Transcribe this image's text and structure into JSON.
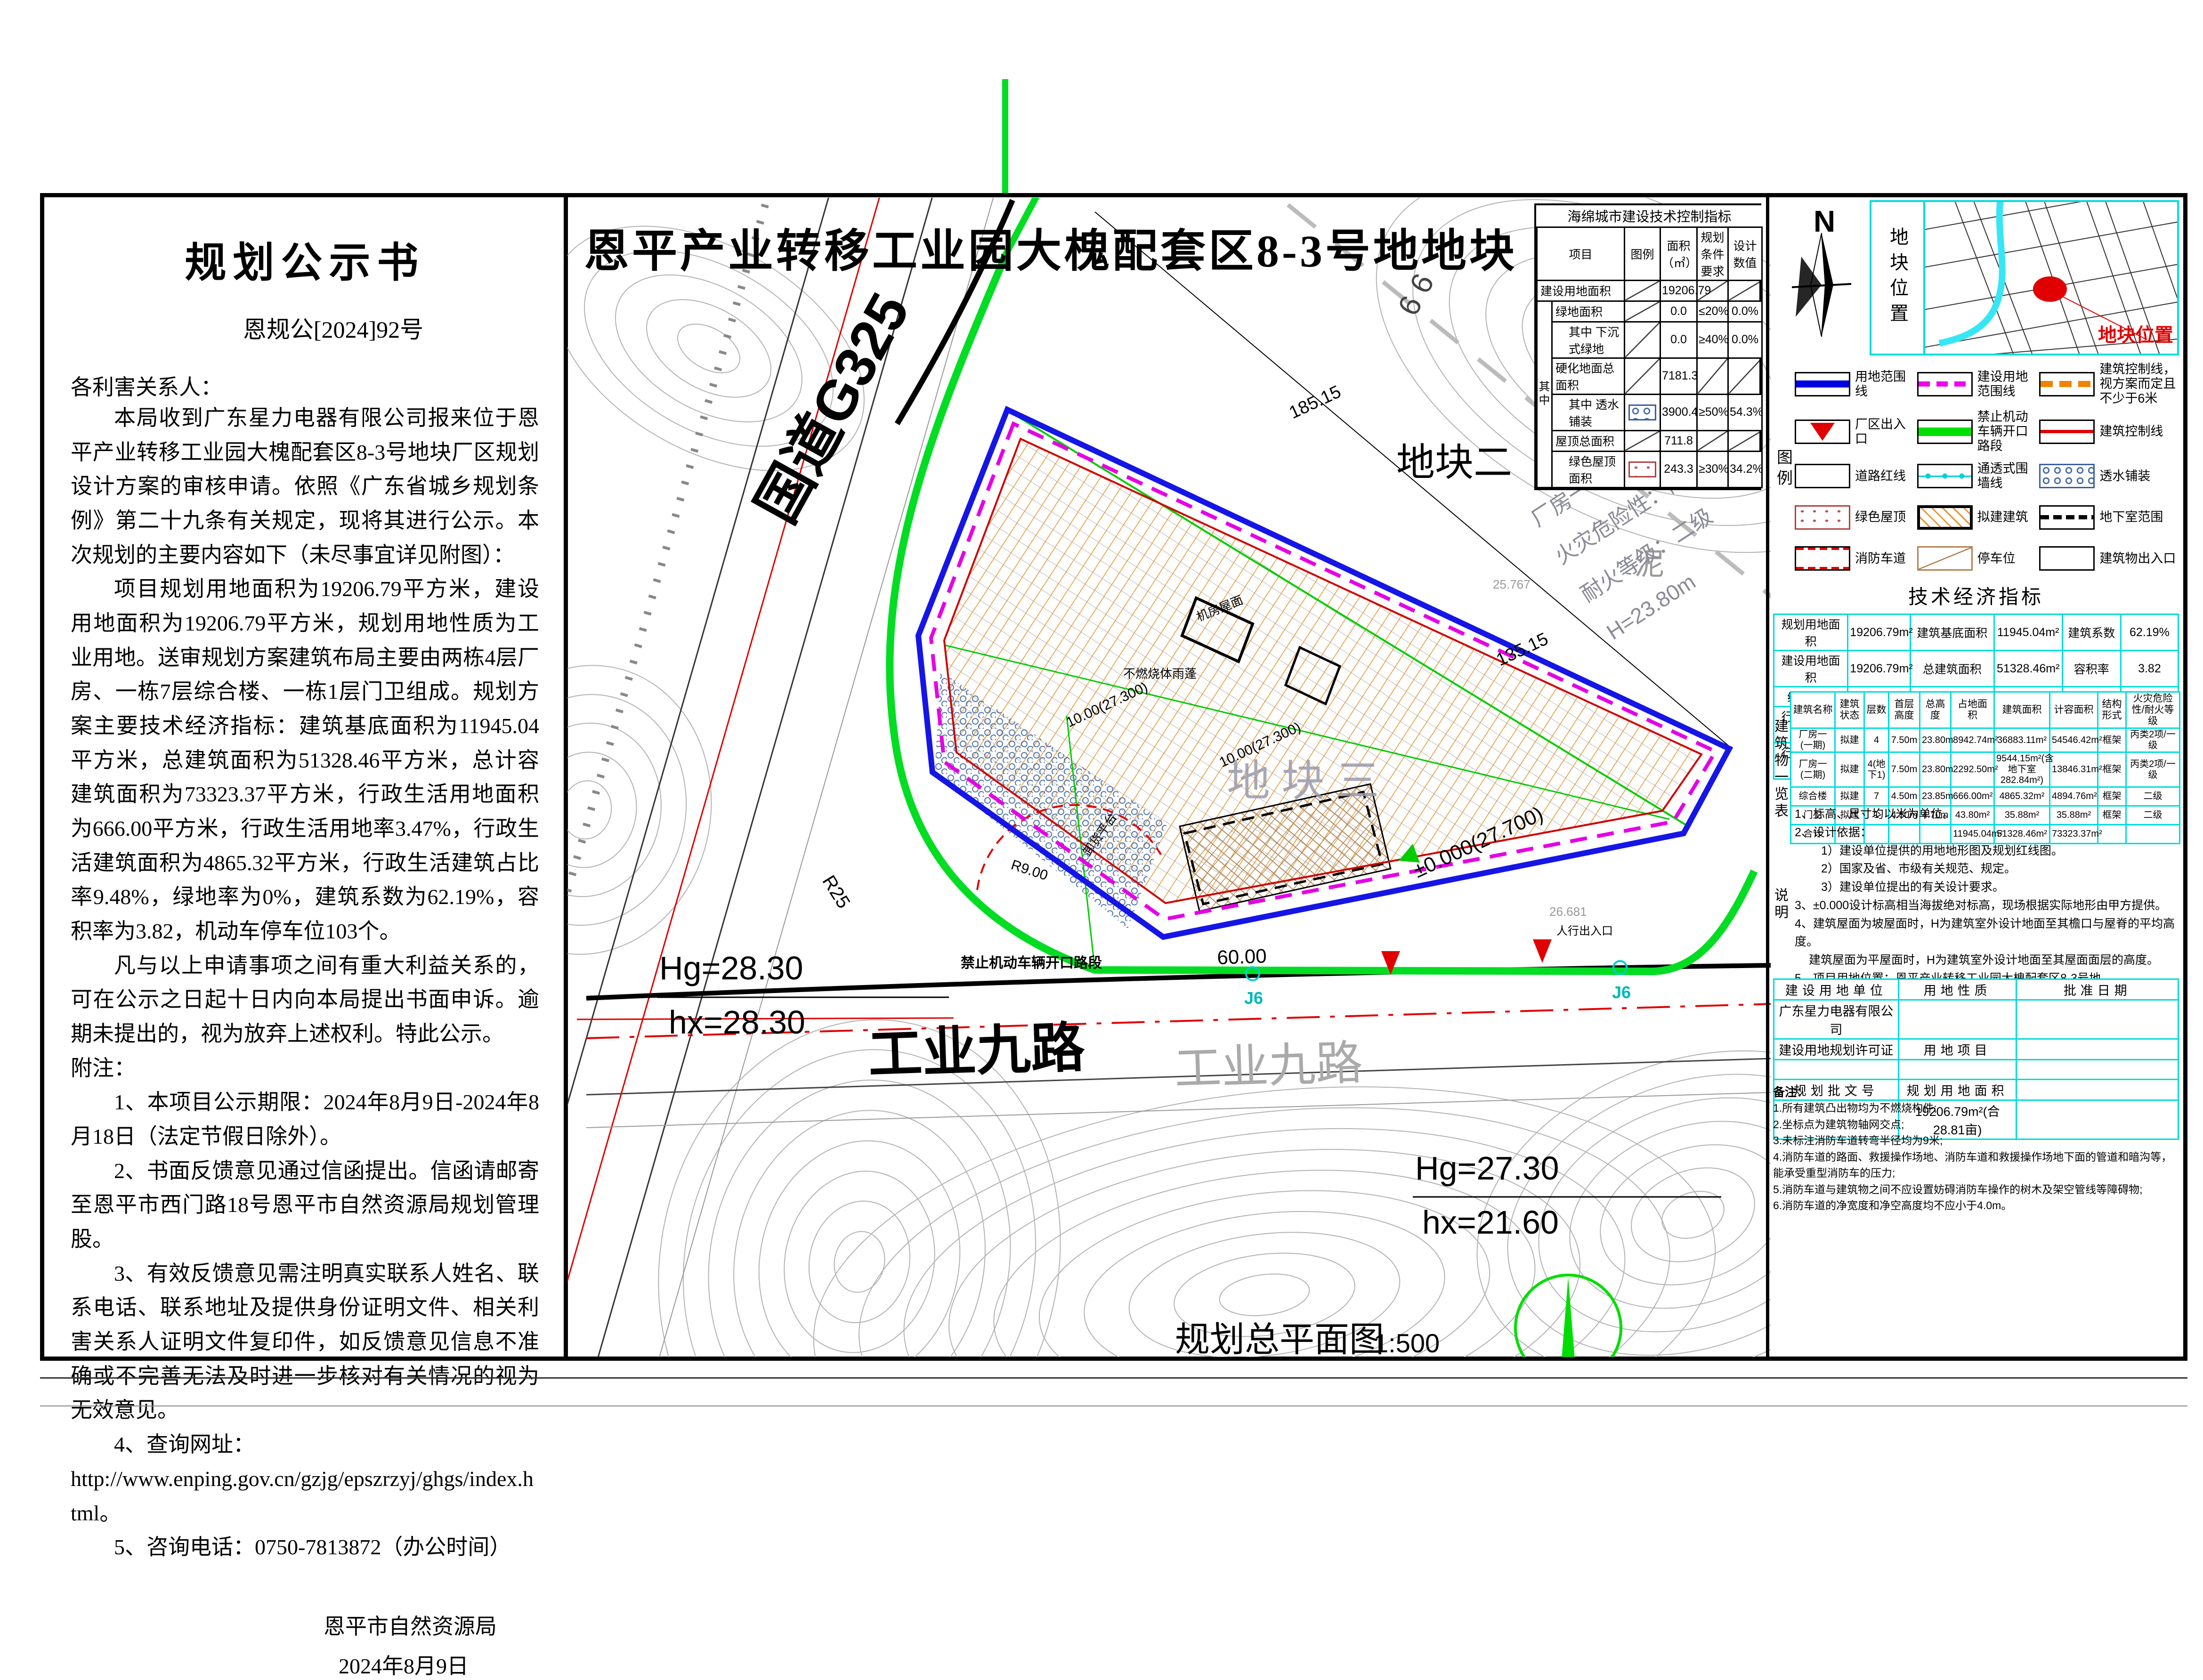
{
  "notice": {
    "title": "规划公示书",
    "doc_no": "恩规公[2024]92号",
    "salutation": "各利害关系人：",
    "paragraphs": [
      "本局收到广东星力电器有限公司报来位于恩平产业转移工业园大槐配套区8-3号地块厂区规划设计方案的审核申请。依照《广东省城乡规划条例》第二十九条有关规定，现将其进行公示。本次规划的主要内容如下（未尽事宜详见附图）：",
      "项目规划用地面积为19206.79平方米，建设用地面积为19206.79平方米，规划用地性质为工业用地。送审规划方案建筑布局主要由两栋4层厂房、一栋7层综合楼、一栋1层门卫组成。规划方案主要技术经济指标：建筑基底面积为11945.04平方米，总建筑面积为51328.46平方米，总计容建筑面积为73323.37平方米，行政生活用地面积为666.00平方米，行政生活用地率3.47%，行政生活建筑面积为4865.32平方米，行政生活建筑占比率9.48%，绿地率为0%，建筑系数为62.19%，容积率为3.82，机动车停车位103个。",
      "凡与以上申请事项之间有重大利益关系的，可在公示之日起十日内向本局提出书面申诉。逾期未提出的，视为放弃上述权利。特此公示。"
    ],
    "notes_label": "附注：",
    "notes": [
      {
        "t": "1、本项目公示期限：2024年8月9日-2024年8月18日（法定节假日除外）。",
        "c": "n-i2"
      },
      {
        "t": "2、书面反馈意见通过信函提出。信函请邮寄至恩平市西门路18号恩平市自然资源局规划管理股。",
        "c": "n-i2"
      },
      {
        "t": "3、有效反馈意见需注明真实联系人姓名、联系电话、联系地址及提供身份证明文件、相关利害关系人证明文件复印件，如反馈意见信息不准确或不完善无法及时进一步核对有关情况的视为无效意见。",
        "c": "n-i2"
      },
      {
        "t": "4、查询网址：",
        "c": "n-i2"
      },
      {
        "t": "http://www.enping.gov.cn/gzjg/epszrzyj/ghgs/index.html。",
        "c": "n-i0"
      },
      {
        "t": "5、咨询电话：0750-7813872（办公时间）",
        "c": "n-i2"
      }
    ],
    "agency": "恩平市自然资源局",
    "date": "2024年8月9日"
  },
  "map": {
    "title": "恩平产业转移工业园大槐配套区8-3号地地块",
    "caption": "规划总平面图",
    "caption_scale": "1:500",
    "road_g325": "国道G325",
    "road_gy9_a": "工业九路",
    "road_gy9_b": "工业九路",
    "elev_left_top": "Hg=28.30",
    "elev_left_bottom": "hx=28.30",
    "elev_right_top": "Hg=27.30",
    "elev_right_bottom": "hx=21.60",
    "parcel2": "地块二",
    "parcel3": "地块三",
    "mud": "泥",
    "no_open": "禁止机动车辆开口路段",
    "dim_a": "185.15",
    "dim_b": "135.15",
    "dim_c": "60.00",
    "dim_r": "R25",
    "dim_r9": "R9.00",
    "bm": "±0.000(27.700)",
    "lvl_a": "10.00(27.300)",
    "lvl_b": "10.00(27.300)",
    "spot_a": "25.767",
    "spot_b": "26.681",
    "bldg_line1": "厂房一（一期）",
    "bldg_line2": "火灾危险性：丙类",
    "bldg_line3": "耐火等级：二级",
    "bldg_line4": "H=23.80m",
    "lbl_canopy": "不燃烧体雨蓬",
    "lbl_dock": "卸货平台",
    "lbl_roof": "机房屋面",
    "lbl_ped": "人行出入口",
    "j_a": "J6",
    "j_b": "J6",
    "sixsix": "6 6"
  },
  "sponge": {
    "title": "海绵城市建设技术控制指标",
    "headers": [
      "项目",
      "图例",
      "面积（㎡）",
      "规划条件要求",
      "设计数值"
    ],
    "span_label": "其中",
    "rows": [
      {
        "label": "建设用地面积",
        "area": "19206.79",
        "req": "",
        "des": ""
      },
      {
        "label": "绿地面积",
        "area": "0.0",
        "req": "≤20%",
        "des": "0.0%"
      },
      {
        "label": "其中 下沉式绿地",
        "area": "0.0",
        "req": "≥40%",
        "des": "0.0%"
      },
      {
        "label": "硬化地面总面积",
        "area": "7181.3",
        "req": "",
        "des": ""
      },
      {
        "label": "其中 透水铺装",
        "area": "3900.4",
        "req": "≥50%",
        "des": "54.3%"
      },
      {
        "label": "屋顶总面积",
        "area": "711.8",
        "req": "",
        "des": ""
      },
      {
        "label": "绿色屋顶面积",
        "area": "243.3",
        "req": "≥30%",
        "des": "34.2%"
      }
    ]
  },
  "panel": {
    "compass_n": "N",
    "strip_label": "地块位置",
    "map_callout": "地块位置",
    "legend_side": "图例",
    "legend_items": [
      {
        "label": "用地范围线",
        "type": "sym-blueband"
      },
      {
        "label": "建设用地范围线",
        "type": "sym-magentadash"
      },
      {
        "label": "建筑控制线，视方案而定且不少于6米",
        "type": "sym-orangedash"
      },
      {
        "label": "厂区出入口",
        "type": "sym-redtri"
      },
      {
        "label": "禁止机动车辆开口路段",
        "type": "sym-greenband"
      },
      {
        "label": "建筑控制线",
        "type": "sym-redline"
      },
      {
        "label": "道路红线",
        "type": "sym-roadred"
      },
      {
        "label": "通透式围墙线",
        "type": "sym-fence"
      },
      {
        "label": "透水铺装",
        "type": "sym-hex"
      },
      {
        "label": "绿色屋顶",
        "type": "sym-plus"
      },
      {
        "label": "拟建建筑",
        "type": "sym-building"
      },
      {
        "label": "地下室范围",
        "type": "sym-basement"
      },
      {
        "label": "消防车道",
        "type": "sym-firelane"
      },
      {
        "label": "停车位",
        "type": "sym-parking"
      },
      {
        "label": "建筑物出入口",
        "type": "sym-entry"
      }
    ]
  },
  "tech": {
    "title": "技术经济指标",
    "rows": [
      [
        "规划用地面积",
        "19206.79m²",
        "建筑基底面积",
        "11945.04m²",
        "建筑系数",
        "62.19%"
      ],
      [
        "建设用地面积",
        "19206.79m²",
        "总建筑面积",
        "51328.46m²",
        "容积率",
        "3.82"
      ],
      [
        "绿地面积",
        "0.00m²",
        "计容建筑面积",
        "73323.37m²",
        "绿地率",
        "0.00%"
      ],
      [
        "行政生活用地面积",
        "666.00m²",
        "行政生活用地率",
        "3.47%",
        "停车位",
        "103个"
      ],
      [
        "行政生活建筑面积",
        "4865.32m²",
        "行政生活建筑面积占比率",
        "9.48%",
        "",
        ""
      ]
    ]
  },
  "bldg": {
    "side_label": "建筑物一览表",
    "headers": [
      "建筑名称",
      "建筑状态",
      "层数",
      "首层高度",
      "总高度",
      "占地面积",
      "建筑面积",
      "计容面积",
      "结构形式",
      "火灾危险性/耐火等级"
    ],
    "rows": [
      [
        "厂房一(一期)",
        "拟建",
        "4",
        "7.50m",
        "23.80m",
        "8942.74m²",
        "36883.11m²",
        "54546.42m²",
        "框架",
        "丙类2项/一级"
      ],
      [
        "厂房一(二期)",
        "拟建",
        "4(地下1)",
        "7.50m",
        "23.80m",
        "2292.50m²",
        "9544.15m²(含地下室282.84m²)",
        "13846.31m²",
        "框架",
        "丙类2项/一级"
      ],
      [
        "综合楼",
        "拟建",
        "7",
        "4.50m",
        "23.85m",
        "666.00m²",
        "4865.32m²",
        "4894.76m²",
        "框架",
        "二级"
      ],
      [
        "门卫",
        "拟建",
        "1",
        "4.50m",
        "4.70m",
        "43.80m²",
        "35.88m²",
        "35.88m²",
        "框架",
        "二级"
      ],
      [
        "合计",
        "",
        "",
        "",
        "",
        "11945.04m²",
        "51328.46m²",
        "73323.37m²",
        "",
        ""
      ]
    ]
  },
  "design_notes": {
    "side_label": "说明",
    "lines": [
      {
        "t": "1、标高、尺寸均以米为单位。",
        "c": "n0"
      },
      {
        "t": "2、设计依据：",
        "c": "n0"
      },
      {
        "t": "1）建设单位提供的用地地形图及规划红线图。",
        "c": "n1"
      },
      {
        "t": "2）国家及省、市级有关规范、规定。",
        "c": "n1"
      },
      {
        "t": "3）建设单位提出的有关设计要求。",
        "c": "n1"
      },
      {
        "t": "3、±0.000设计标高相当海拔绝对标高，现场根据实际地形由甲方提供。",
        "c": "n0"
      },
      {
        "t": "4、建筑屋面为坡屋面时，H为建筑室外设计地面至其檐口与屋脊的平均高度。",
        "c": "n0"
      },
      {
        "t": "建筑屋面为平屋面时，H为建筑室外设计地面至其屋面面层的高度。",
        "c": "n2"
      },
      {
        "t": "5、项目用地位置：恩平产业转移工业园大槐配套区8-3号地。",
        "c": "n0"
      },
      {
        "t": "6、本次报建内容：厂房一（一期）、厂房一（二期）、综合楼、门卫。",
        "c": "n0"
      }
    ]
  },
  "info": {
    "rows": [
      [
        "建设用地单位",
        "用地性质",
        "批准日期"
      ],
      [
        "广东星力电器有限公司",
        "",
        ""
      ],
      [
        "建设用地规划许可证",
        "用地项目",
        ""
      ],
      [
        "",
        "",
        ""
      ],
      [
        "规划批文号",
        "规划用地面积",
        ""
      ],
      [
        "",
        "19206.79m²(合28.81亩)",
        ""
      ]
    ]
  },
  "remarks": {
    "label": "备注：",
    "lines": [
      "1.所有建筑凸出物均为不燃烧构件;",
      "2.坐标点为建筑物轴网交点;",
      "3.未标注消防车道转弯半径均为9米;",
      "4.消防车道的路面、救援操作场地、消防车道和救援操作场地下面的管道和暗沟等，能承受重型消防车的压力;",
      "5.消防车道与建筑物之间不应设置妨碍消防车操作的树木及架空管线等障碍物;",
      "6.消防车道的净宽度和净空高度均不应小于4.0m。"
    ]
  }
}
